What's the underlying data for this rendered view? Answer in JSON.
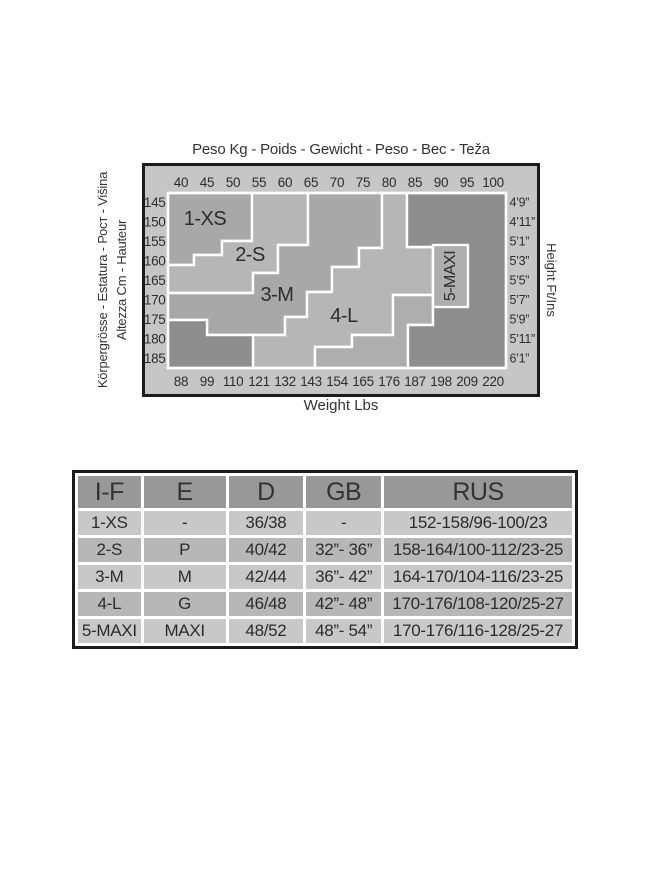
{
  "chart": {
    "title_top": "Peso Kg - Poids - Gewicht - Peso - Вес - Teža",
    "bottom_label": "Weight Lbs",
    "left_label_outer": "Körpergrösse - Estatura - Рост - Višina",
    "left_label_inner": "Altezza Cm - Hauteur",
    "right_label": "Height Ft/Ins",
    "axis": {
      "kg": [
        "40",
        "45",
        "50",
        "55",
        "60",
        "65",
        "70",
        "75",
        "80",
        "85",
        "90",
        "95",
        "100"
      ],
      "lbs": [
        "88",
        "99",
        "110",
        "121",
        "132",
        "143",
        "154",
        "165",
        "176",
        "187",
        "198",
        "209",
        "220"
      ],
      "cm": [
        "145",
        "150",
        "155",
        "160",
        "165",
        "170",
        "175",
        "180",
        "185"
      ],
      "ftins": [
        "4’9”",
        "4’11”",
        "5’1”",
        "5’3”",
        "5’5”",
        "5’7”",
        "5’9”",
        "5’11”",
        "6’1”"
      ]
    },
    "colors": {
      "frame_bg": "#c6c6c6",
      "zone_a": "#a8a8a8",
      "zone_b": "#b6b6b6",
      "mid": "#aeaeae",
      "dark": "#8e8e8e",
      "line": "#ffffff",
      "border": "#1b1b1b",
      "text": "#2d2d2d"
    },
    "frame": {
      "w": 398,
      "h": 234
    },
    "plot": {
      "x": 26,
      "y": 30,
      "w": 338,
      "h": 175
    },
    "zones": [
      {
        "name": "zone-1xs",
        "fill": "zone_a",
        "label": "1-XS",
        "lx": 37,
        "ly": 26,
        "points": [
          [
            0,
            0
          ],
          [
            84,
            0
          ],
          [
            84,
            48
          ],
          [
            54,
            48
          ],
          [
            54,
            62
          ],
          [
            26,
            62
          ],
          [
            26,
            72
          ],
          [
            0,
            72
          ]
        ]
      },
      {
        "name": "zone-2s",
        "fill": "zone_b",
        "label": "2-S",
        "lx": 82,
        "ly": 62,
        "points": [
          [
            84,
            0
          ],
          [
            140,
            0
          ],
          [
            140,
            52
          ],
          [
            110,
            52
          ],
          [
            110,
            80
          ],
          [
            85,
            80
          ],
          [
            85,
            100
          ],
          [
            0,
            100
          ],
          [
            0,
            72
          ],
          [
            26,
            72
          ],
          [
            26,
            62
          ],
          [
            54,
            62
          ],
          [
            54,
            48
          ],
          [
            84,
            48
          ]
        ]
      },
      {
        "name": "zone-3m",
        "fill": "zone_a",
        "label": "3-M",
        "lx": 109,
        "ly": 102,
        "points": [
          [
            140,
            0
          ],
          [
            214,
            0
          ],
          [
            214,
            55
          ],
          [
            191,
            55
          ],
          [
            191,
            74
          ],
          [
            164,
            74
          ],
          [
            164,
            99
          ],
          [
            139,
            99
          ],
          [
            139,
            124
          ],
          [
            117,
            124
          ],
          [
            117,
            142
          ],
          [
            39,
            142
          ],
          [
            39,
            127
          ],
          [
            0,
            127
          ],
          [
            0,
            100
          ],
          [
            85,
            100
          ],
          [
            85,
            80
          ],
          [
            110,
            80
          ],
          [
            110,
            52
          ],
          [
            140,
            52
          ]
        ]
      },
      {
        "name": "zone-4l",
        "fill": "zone_b",
        "label": "4-L",
        "lx": 176,
        "ly": 123,
        "points": [
          [
            214,
            0
          ],
          [
            239,
            0
          ],
          [
            239,
            54
          ],
          [
            265,
            54
          ],
          [
            265,
            102
          ],
          [
            225,
            102
          ],
          [
            225,
            142
          ],
          [
            184,
            142
          ],
          [
            184,
            154
          ],
          [
            147,
            154
          ],
          [
            147,
            175
          ],
          [
            85,
            175
          ],
          [
            85,
            142
          ],
          [
            117,
            142
          ],
          [
            117,
            124
          ],
          [
            139,
            124
          ],
          [
            139,
            99
          ],
          [
            164,
            99
          ],
          [
            164,
            74
          ],
          [
            191,
            74
          ],
          [
            191,
            55
          ],
          [
            214,
            55
          ]
        ]
      },
      {
        "name": "zone-5maxi-extension",
        "fill": "mid",
        "label": "",
        "lx": 0,
        "ly": 0,
        "points": [
          [
            225,
            102
          ],
          [
            265,
            102
          ],
          [
            265,
            132
          ],
          [
            240,
            132
          ],
          [
            240,
            175
          ],
          [
            147,
            175
          ],
          [
            147,
            154
          ],
          [
            184,
            154
          ],
          [
            184,
            142
          ],
          [
            225,
            142
          ]
        ]
      },
      {
        "name": "no-size-bottom-left",
        "fill": "dark",
        "label": "",
        "lx": 0,
        "ly": 0,
        "points": [
          [
            0,
            127
          ],
          [
            39,
            127
          ],
          [
            39,
            142
          ],
          [
            85,
            142
          ],
          [
            85,
            175
          ],
          [
            0,
            175
          ]
        ]
      },
      {
        "name": "no-size-right",
        "fill": "dark",
        "label": "",
        "lx": 0,
        "ly": 0,
        "points": [
          [
            239,
            0
          ],
          [
            338,
            0
          ],
          [
            338,
            175
          ],
          [
            240,
            175
          ],
          [
            240,
            132
          ],
          [
            265,
            132
          ],
          [
            265,
            54
          ],
          [
            239,
            54
          ]
        ]
      }
    ],
    "maxibox": {
      "x": 265,
      "y": 52,
      "w": 35,
      "h": 62,
      "label": "5-MAXI",
      "fill": "mid"
    }
  },
  "table": {
    "headers": [
      "I-F",
      "E",
      "D",
      "GB",
      "RUS"
    ],
    "rows": [
      [
        "1-XS",
        "-",
        "36/38",
        "-",
        "152-158/96-100/23"
      ],
      [
        "2-S",
        "P",
        "40/42",
        "32”- 36”",
        "158-164/100-112/23-25"
      ],
      [
        "3-M",
        "M",
        "42/44",
        "36”- 42”",
        "164-170/104-116/23-25"
      ],
      [
        "4-L",
        "G",
        "46/48",
        "42”- 48”",
        "170-176/108-120/25-27"
      ],
      [
        "5-MAXI",
        "MAXI",
        "48/52",
        "48”- 54”",
        "170-176/116-128/25-27"
      ]
    ]
  }
}
